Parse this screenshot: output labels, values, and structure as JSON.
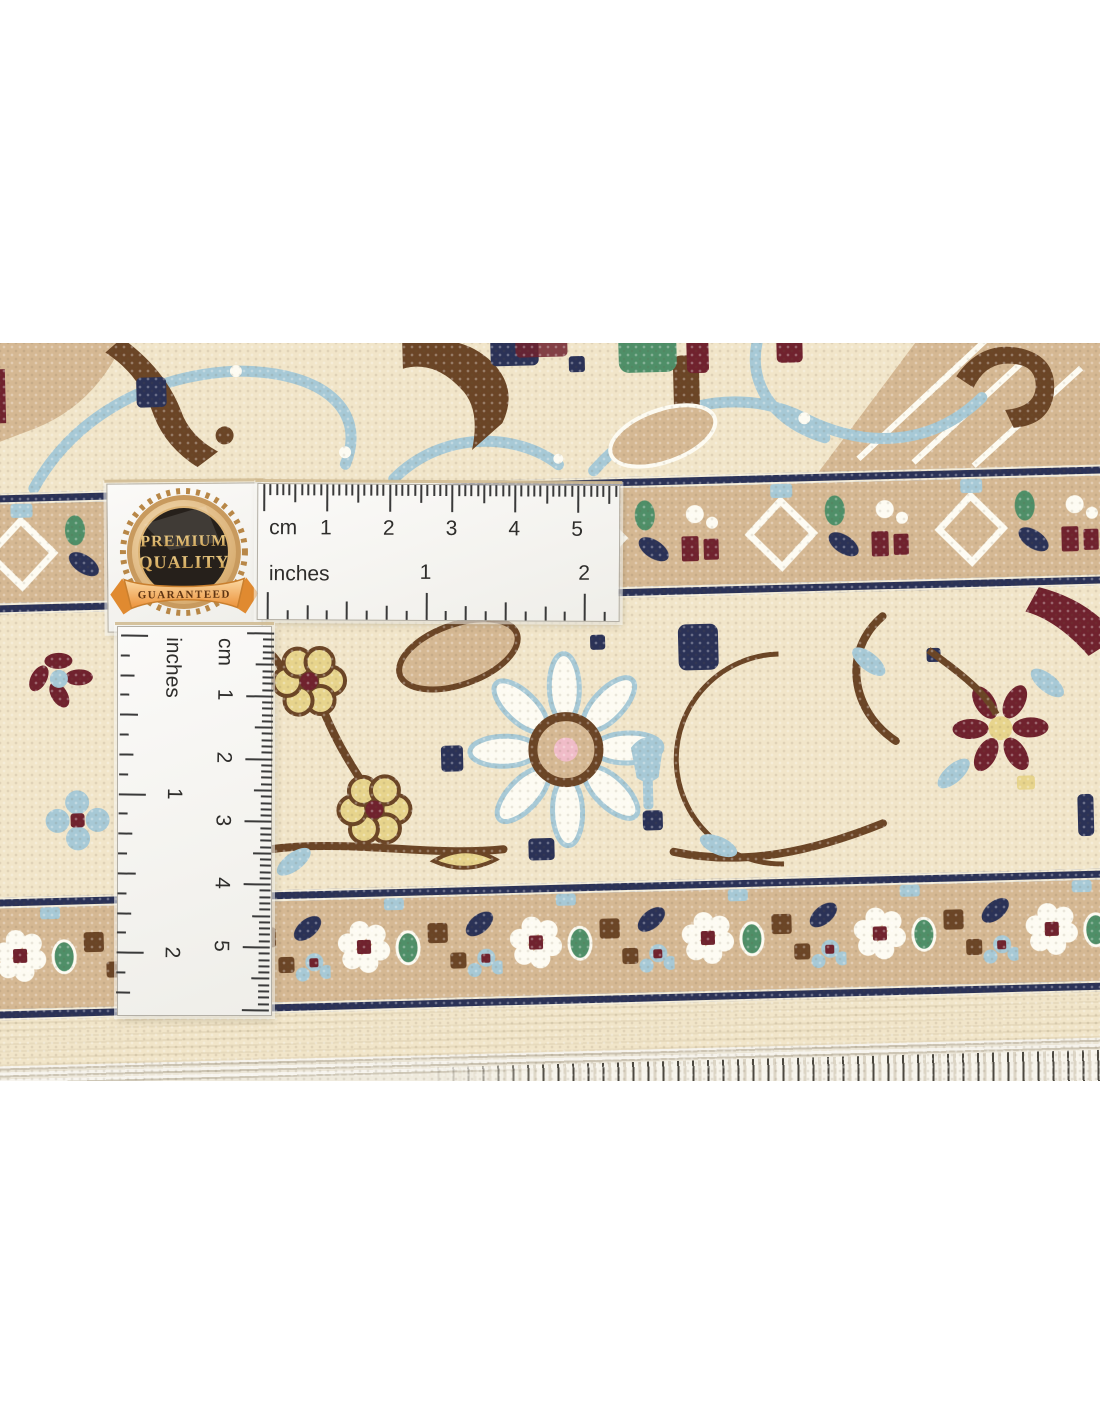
{
  "rug_photo": {
    "badge": {
      "title_line1": "PREMIUM",
      "title_line2": "QUALITY",
      "ribbon_text": "GUARANTEED"
    },
    "ruler": {
      "unit_cm": "cm",
      "unit_inches": "inches",
      "cm_numbers": [
        "1",
        "2",
        "3",
        "4",
        "5"
      ],
      "inch_numbers": [
        "1",
        "2"
      ]
    },
    "colors": {
      "cream": "#f1e5c9",
      "tan": "#d5b893",
      "navy": "#2b3257",
      "light_blue": "#a7c9d6",
      "brown": "#6b4526",
      "maroon": "#70222e",
      "green": "#4f8f68",
      "yellow": "#e7d48c",
      "pink": "#f0bcc8",
      "fringe": "#e9e2d2",
      "tick": "#3a3a3a",
      "badge_gold": "#d9b36a",
      "badge_dark": "#26201b",
      "ribbon_orange": "#ef9d48"
    }
  }
}
